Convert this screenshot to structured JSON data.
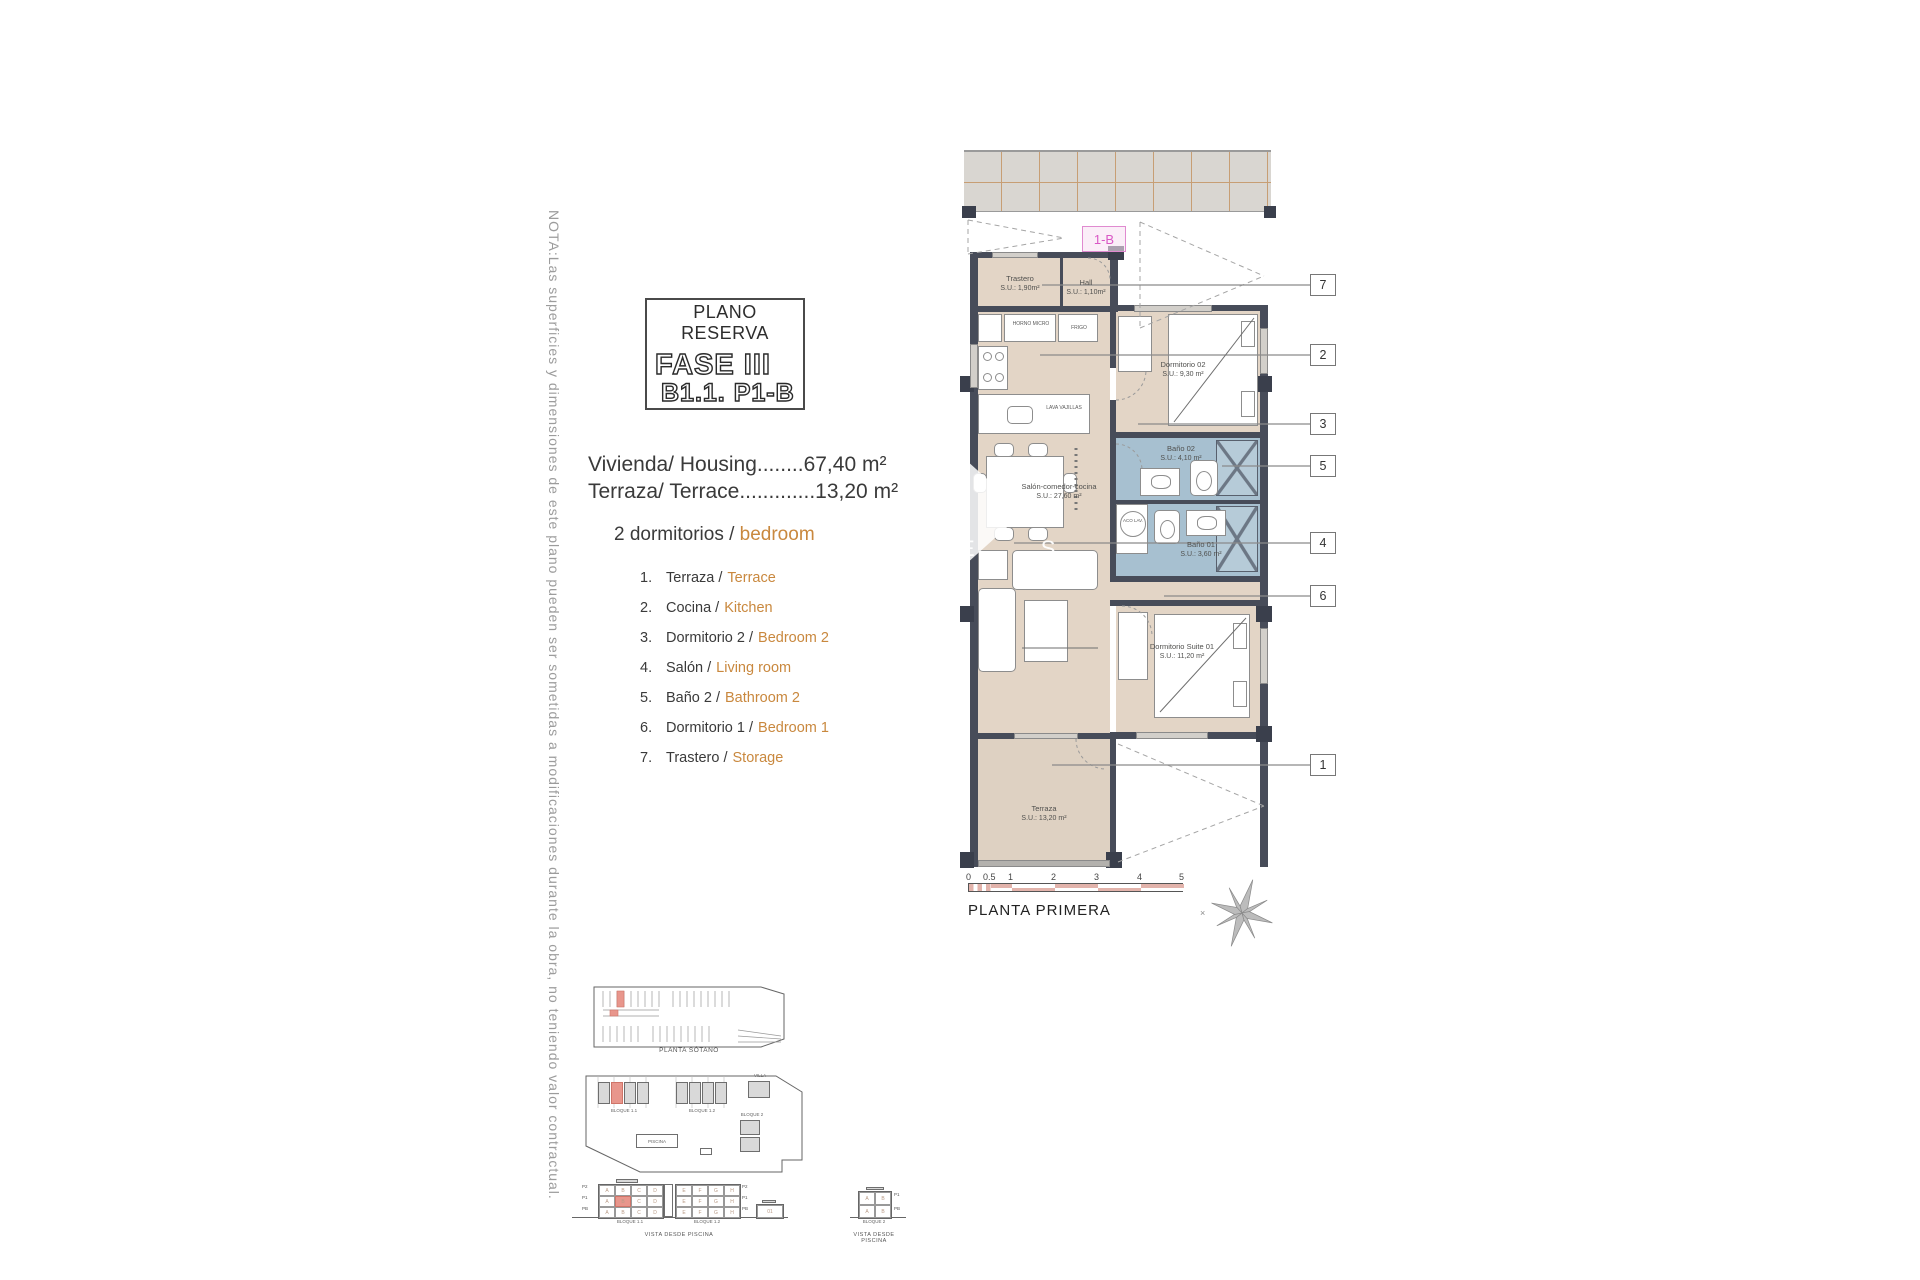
{
  "note_vertical": "NOTA:Las superficies y dimensiones de este plano pueden ser sometidas a modificaciones durante la obra, no teniendo valor contractual.",
  "title_box": {
    "line1": "PLANO RESERVA",
    "line2": "FASE III",
    "line3": "B1.1. P1-B"
  },
  "areas": {
    "housing": "Vivienda/ Housing........67,40 m²",
    "terrace": "Terraza/ Terrace.............13,20 m²"
  },
  "bedrooms_heading": {
    "es": "2 dormitorios /",
    "en": "bedroom"
  },
  "legend": [
    {
      "num": "1.",
      "es": "Terraza /",
      "en": "Terrace"
    },
    {
      "num": "2.",
      "es": "Cocina /",
      "en": "Kitchen"
    },
    {
      "num": "3.",
      "es": "Dormitorio 2 /",
      "en": "Bedroom 2"
    },
    {
      "num": "4.",
      "es": "Salón /",
      "en": "Living room"
    },
    {
      "num": "5.",
      "es": "Baño 2 /",
      "en": "Bathroom 2"
    },
    {
      "num": "6.",
      "es": "Dormitorio 1 /",
      "en": "Bedroom 1"
    },
    {
      "num": "7.",
      "es": "Trastero /",
      "en": "Storage"
    }
  ],
  "plan": {
    "unit_tag": "1-B",
    "watermark": "E S",
    "rooms": {
      "trastero": {
        "name": "Trastero",
        "area": "S.U.: 1,90m²"
      },
      "hall": {
        "name": "Hall",
        "area": "S.U.: 1,10m²"
      },
      "dorm2": {
        "name": "Dormitorio 02",
        "area": "S.U.: 9,30 m²"
      },
      "bano2": {
        "name": "Baño 02",
        "area": "S.U.: 4,10 m²"
      },
      "bano1": {
        "name": "Baño 01",
        "area": "S.U.: 3,60 m²"
      },
      "salon": {
        "name": "Salón-comedor-cocina",
        "area": "S.U.: 27,60 m²"
      },
      "suite": {
        "name": "Dormitorio Suite 01",
        "area": "S.U.: 11,20 m²"
      },
      "terraza": {
        "name": "Terraza",
        "area": "S.U.: 13,20 m²"
      }
    },
    "labels": {
      "horno": "HORNO MICRO",
      "frigo": "FRIGO",
      "lava": "LAVA VAJILLAS",
      "aco": "ACO LAV."
    },
    "callouts": [
      "7",
      "2",
      "3",
      "5",
      "4",
      "6",
      "1"
    ],
    "scale_ticks": [
      "0",
      "0.5",
      "1",
      "2",
      "3",
      "4",
      "5"
    ],
    "floor_label": "PLANTA PRIMERA"
  },
  "minimaps": {
    "sotano_caption": "PLANTA SÓTANO",
    "site": {
      "bloque11": "BLOQUE 1.1",
      "bloque12": "BLOQUE 1.2",
      "bloque2": "BLOQUE 2",
      "villa": "VILLA",
      "piscina": "PISCINA"
    },
    "elevation": {
      "bloque11": "BLOQUE 1.1",
      "bloque12": "BLOQUE 1.2",
      "bloque2": "BLOQUE 2",
      "villa": "01",
      "caption": "VISTA DESDE PISCINA",
      "floors": [
        "P2",
        "P1",
        "PB"
      ],
      "floors2": [
        "P1",
        "PB"
      ],
      "units_left": [
        "A",
        "B",
        "C",
        "D"
      ],
      "units_right": [
        "E",
        "F",
        "G",
        "H"
      ],
      "units_b2": [
        "A",
        "B"
      ]
    }
  },
  "colors": {
    "accent_orange": "#c9883e",
    "room_beige": "#e3d5c6",
    "bath_blue": "#a7c0d0",
    "wall_dark": "#474c59",
    "highlight_pink": "#e8968c",
    "scale_pink": "#e2b3ab",
    "tag_pink": "#d957c5"
  }
}
